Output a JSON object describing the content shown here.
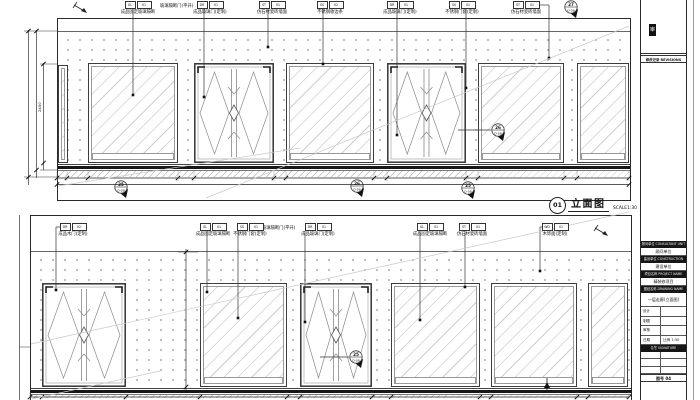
{
  "colors": {
    "line": "#2a2a2a",
    "light_line": "#c9c9c9",
    "dots": "#ababab"
  },
  "title_marker": {
    "number": "01",
    "title": "立面图",
    "scale_label": "SCALE1:30"
  },
  "callouts": {
    "top_note": "玻璃隔断门(平开)",
    "bottom_note": "玻璃隔断门(平开)",
    "top": [
      {
        "code1": "GL",
        "code2": "01",
        "label": "成品固定玻璃隔断"
      },
      {
        "code1": "DR",
        "code2": "01",
        "label": "成品玻璃门(定制)"
      },
      {
        "code1": "ST",
        "code2": "01",
        "label": "仿石材瓷砖墙面"
      },
      {
        "code1": "SS",
        "code2": "02",
        "label": "不锈钢收边条"
      },
      {
        "code1": "DR",
        "code2": "01",
        "label": "成品玻璃门(定制)"
      },
      {
        "code1": "SS",
        "code2": "01",
        "label": "不锈钢门套(定制)"
      },
      {
        "code1": "ST",
        "code2": "01",
        "label": "仿石材瓷砖墙面"
      }
    ],
    "bottom": [
      {
        "code1": "DR",
        "code2": "02",
        "label": "成品木门(定制)"
      },
      {
        "code1": "GL",
        "code2": "01",
        "label": "成品固定玻璃隔断"
      },
      {
        "code1": "SS",
        "code2": "01",
        "label": "不锈钢门套(定制)"
      },
      {
        "code1": "DR",
        "code2": "01",
        "label": "成品玻璃门(定制)"
      },
      {
        "code1": "GL",
        "code2": "01",
        "label": "成品固定玻璃隔断"
      },
      {
        "code1": "ST",
        "code2": "01",
        "label": "仿石材瓷砖墙面"
      },
      {
        "code1": "WD",
        "code2": "01",
        "label": "木饰面(定制)"
      }
    ]
  },
  "detail_markers": [
    {
      "num": "25",
      "sheet": "D-08"
    },
    {
      "num": "26",
      "sheet": "D-08"
    },
    {
      "num": "25",
      "sheet": "D-08"
    },
    {
      "num": "26",
      "sheet": "D-08"
    },
    {
      "num": "27",
      "sheet": "D-08"
    },
    {
      "num": "25",
      "sheet": "D-08"
    }
  ],
  "dims": {
    "wall_height_label": "2400"
  },
  "titleblock": {
    "stamp": "审",
    "revisions_header": "修改记录 REVISIONS",
    "rows": [
      {
        "label": "顾问单位 CONSULTANT UNIT",
        "value": "顾问单位"
      },
      {
        "label": "建设单位 CONSTRUCTION UNIT",
        "value": "建设单位"
      },
      {
        "label": "项目名称 PROJECT NAME",
        "value": "精装修项目"
      },
      {
        "label": "图纸名称 DRAWING NAME",
        "value": "一层走廊(立面图)"
      }
    ],
    "info_rows": [
      {
        "l": "设计",
        "r": ""
      },
      {
        "l": "制图",
        "r": ""
      },
      {
        "l": "审核",
        "r": ""
      },
      {
        "l": "日期 2013.07",
        "r": "比例 1:30"
      }
    ],
    "sign_header": "会签 SIGNATURE",
    "sign_rows": [
      {
        "l": "",
        "r": ""
      },
      {
        "l": "",
        "r": ""
      },
      {
        "l": "",
        "r": ""
      }
    ],
    "dwgno": "图号 04"
  }
}
